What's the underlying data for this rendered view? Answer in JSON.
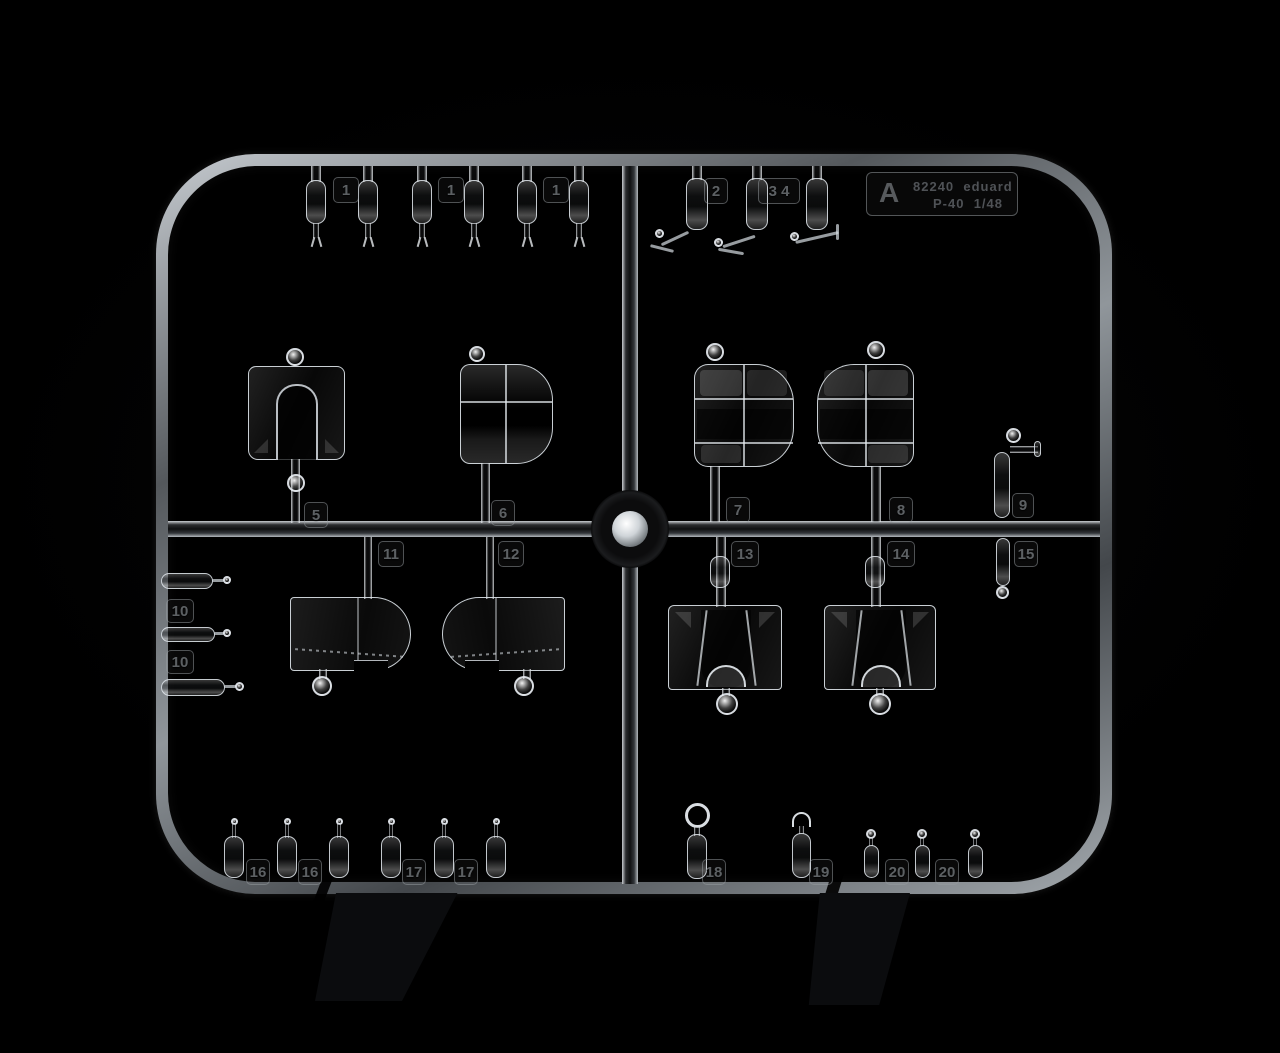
{
  "scene": {
    "subject": "clear injection-molded sprue of aircraft canopy parts on black background",
    "background_color": "#000000",
    "plastic_highlight_color": "#d6dadd"
  },
  "info_plate": {
    "sprue_letter": "A",
    "kit_number": "82240",
    "brand": "eduard",
    "aircraft": "P-40",
    "scale": "1/48"
  },
  "tags": {
    "t1a": "1",
    "t1b": "1",
    "t1c": "1",
    "t2": "2",
    "t34": "3 4",
    "t5": "5",
    "t6": "6",
    "t7": "7",
    "t8": "8",
    "t9": "9",
    "t10a": "10",
    "t10b": "10",
    "t11": "11",
    "t12": "12",
    "t13": "13",
    "t14": "14",
    "t15": "15",
    "t16a": "16",
    "t16b": "16",
    "t17a": "17",
    "t17b": "17",
    "t18": "18",
    "t19": "19",
    "t20a": "20",
    "t20b": "20"
  }
}
